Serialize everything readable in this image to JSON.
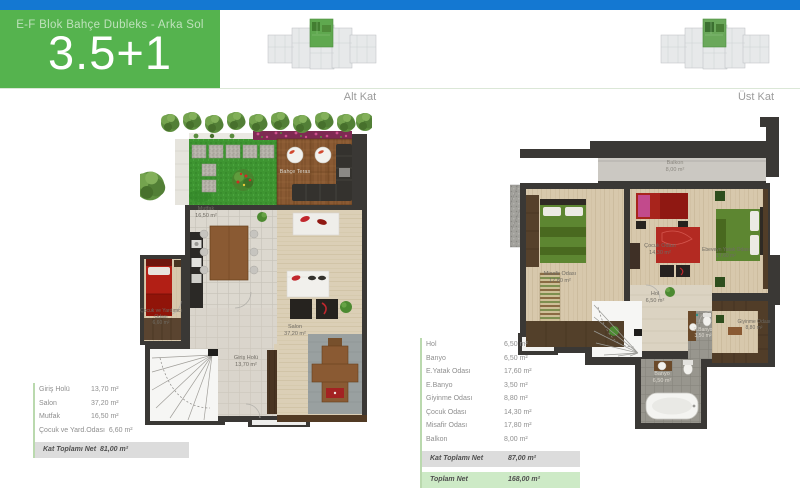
{
  "header": {
    "title": "E-F Blok Bahçe Dubleks - Arka Sol",
    "unit": "3.5+1"
  },
  "floors": {
    "left": "Alt Kat",
    "right": "Üst Kat"
  },
  "colors": {
    "top_bar": "#1478d2",
    "banner_green": "#55b34e",
    "highlight_unit_green": "#5fa84f",
    "total_row_bg": "#dcdcdc",
    "grand_total_row_bg": "#cdeac6",
    "table_accent_line": "#bad9ae"
  },
  "plan_alt": {
    "rooms": {
      "bahce_teras": {
        "name": "Bahçe Teras",
        "area": ""
      },
      "mutfak": {
        "name": "Mutfak",
        "area": "16,50 m²"
      },
      "salon": {
        "name": "Salon",
        "area": "37,20 m²"
      },
      "giris_holu": {
        "name": "Giriş Holü",
        "area": "13,70 m²"
      },
      "cocuk": {
        "name": "Çocuk ve Yardımcı Odası",
        "area": "6,60 m²"
      }
    }
  },
  "plan_ust": {
    "rooms": {
      "balkon": {
        "name": "Balkon",
        "area": "8,00 m²"
      },
      "misafir": {
        "name": "Misafir Odası",
        "area": "17,80 m²"
      },
      "cocuk": {
        "name": "Çocuk Odası",
        "area": "14,30 m²"
      },
      "ebeveyn": {
        "name": "Ebeveyn Yatak Odası",
        "area": "17,60 m²"
      },
      "hol": {
        "name": "Hol",
        "area": "6,50 m²"
      },
      "e_banyo": {
        "name": "E.Banyo",
        "area": "3,50 m²"
      },
      "giyinme": {
        "name": "Giyinme Odası",
        "area": "8,80 m²"
      },
      "banyo": {
        "name": "Banyo",
        "area": "6,50 m²"
      }
    }
  },
  "table_alt": {
    "rows": [
      {
        "label": "Giriş Holü",
        "value": "13,70 m²"
      },
      {
        "label": "Salon",
        "value": "37,20 m²"
      },
      {
        "label": "Mutfak",
        "value": "16,50 m²"
      },
      {
        "label": "Çocuk ve Yard.Odası",
        "value": "6,60 m²"
      }
    ],
    "total": {
      "label": "Kat Toplamı Net",
      "value": "81,00 m²"
    }
  },
  "table_ust": {
    "rows": [
      {
        "label": "Hol",
        "value": "6,50 m²"
      },
      {
        "label": "Banyo",
        "value": "6,50 m²"
      },
      {
        "label": "E.Yatak Odası",
        "value": "17,60 m²"
      },
      {
        "label": "E.Banyo",
        "value": "3,50 m²"
      },
      {
        "label": "Giyinme Odası",
        "value": "8,80 m²"
      },
      {
        "label": "Çocuk Odası",
        "value": "14,30 m²"
      },
      {
        "label": "Misafir Odası",
        "value": "17,80 m²"
      },
      {
        "label": "Balkon",
        "value": "8,00 m²"
      }
    ],
    "total": {
      "label": "Kat Toplamı Net",
      "value": "87,00 m²"
    },
    "grand_total": {
      "label": "Toplam Net",
      "value": "168,00 m²"
    }
  }
}
